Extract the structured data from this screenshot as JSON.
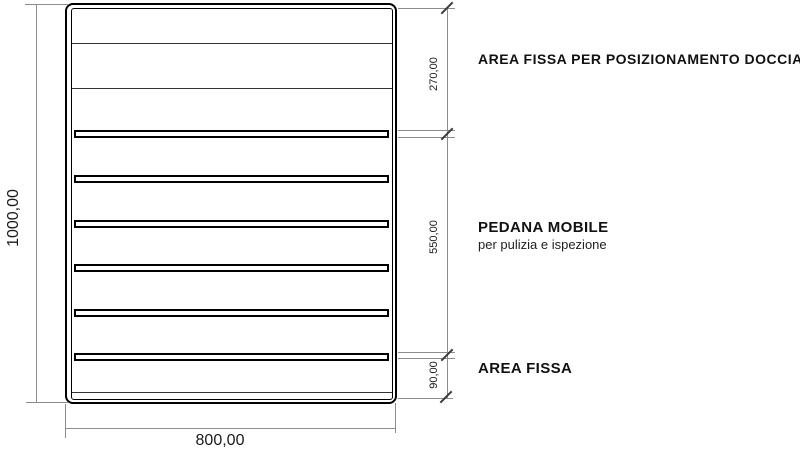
{
  "page": {
    "background": "#ffffff",
    "description": "Technical plan drawing of a slatted shower platform with dimensions"
  },
  "drawing": {
    "slat_tops": [
      130,
      175,
      220,
      264,
      309,
      353
    ],
    "divider_tops": [
      43,
      88,
      392
    ],
    "slat_count": 6
  },
  "dimensions": {
    "overall_height": "1000,00",
    "overall_width": "800,00",
    "top_section": "270,00",
    "middle_section": "550,00",
    "bottom_section": "90,00"
  },
  "labels": {
    "top_section": "AREA FISSA PER POSIZIONAMENTO DOCCIA",
    "middle_section": "PEDANA MOBILE",
    "middle_section_sub": "per pulizia e ispezione",
    "bottom_section": "AREA FISSA"
  },
  "colors": {
    "drawing_line": "#000000",
    "dimension_line": "#8c8c8c",
    "tick": "#3a3a3a",
    "text": "#1a1a1a"
  }
}
